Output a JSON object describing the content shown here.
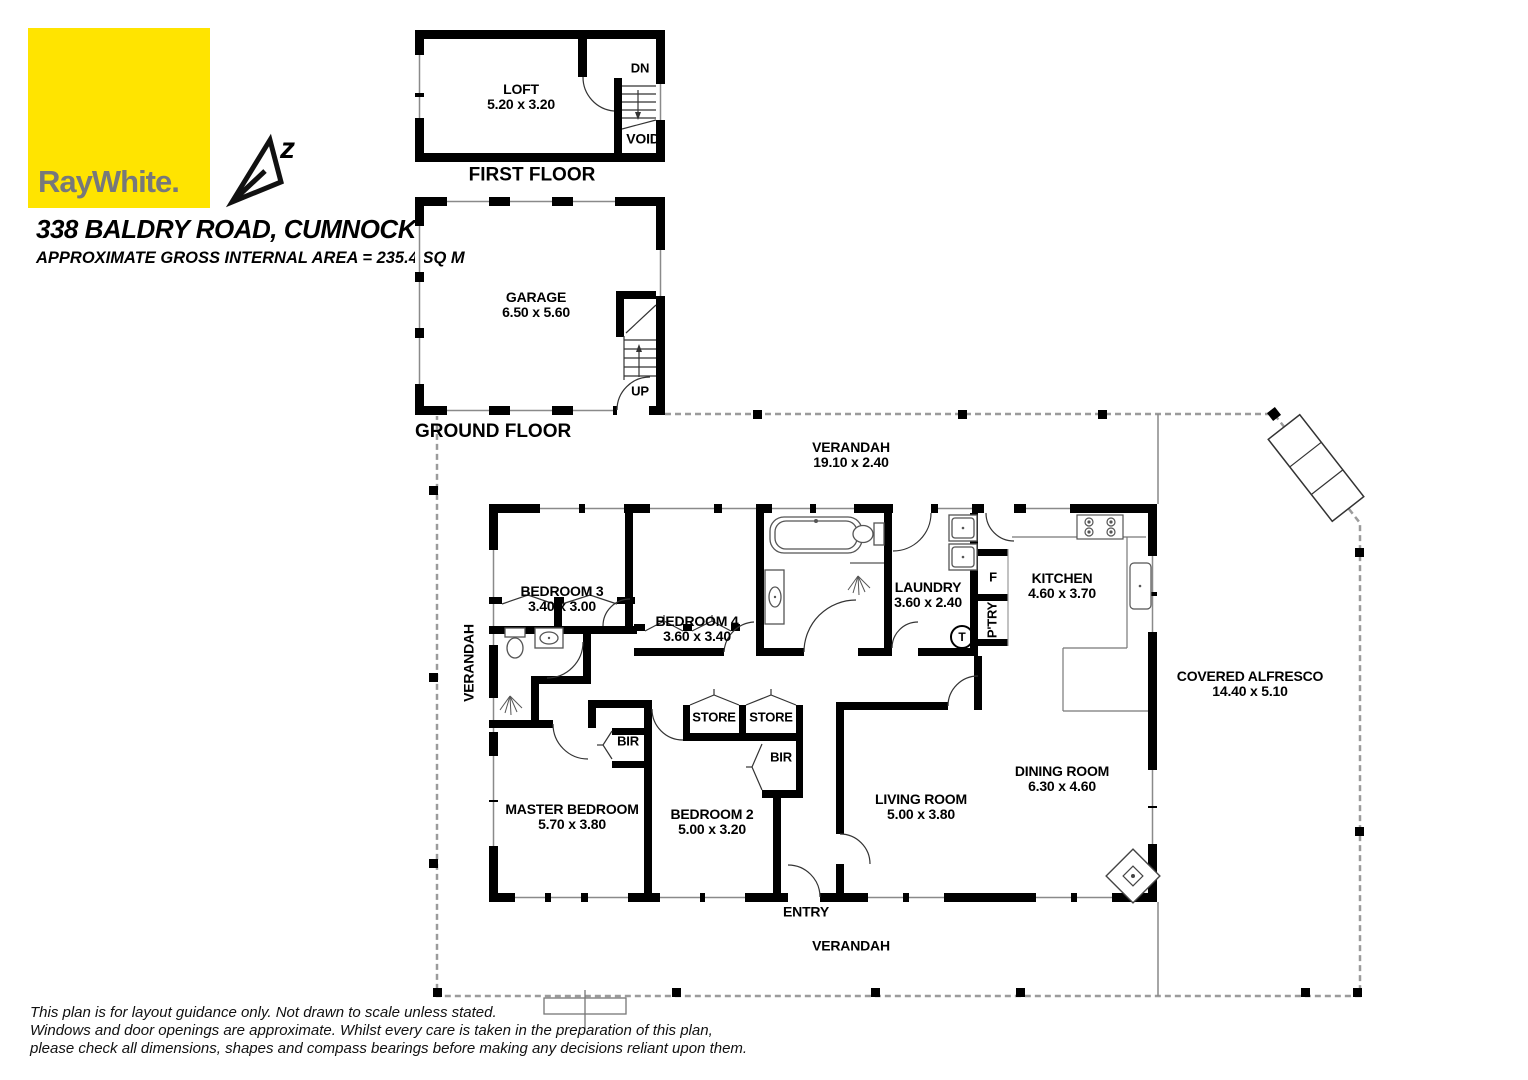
{
  "colors": {
    "brand_yellow": "#ffe400",
    "brand_gray": "#77787b",
    "wall": "#000000"
  },
  "brand": {
    "logo_text": "RayWhite.",
    "compass_letter": "z"
  },
  "header": {
    "address": "338 BALDRY ROAD, CUMNOCK",
    "area_line": "APPROXIMATE GROSS INTERNAL AREA = 235.4 SQ M"
  },
  "first_floor": {
    "title": "FIRST FLOOR",
    "room": "LOFT",
    "dims": "5.20 x 3.20",
    "dn": "DN",
    "void": "VOID"
  },
  "ground_floor": {
    "title": "GROUND FLOOR",
    "room": "GARAGE",
    "dims": "6.50 x 5.60",
    "up": "UP"
  },
  "plan": {
    "verandah_top": {
      "name": "VERANDAH",
      "dims": "19.10 x 2.40"
    },
    "verandah_left": "VERANDAH",
    "verandah_bottom": "VERANDAH",
    "alfresco": {
      "name": "COVERED ALFRESCO",
      "dims": "14.40 x 5.10"
    },
    "entry": "ENTRY",
    "bedroom3": {
      "name": "BEDROOM 3",
      "dims": "3.40 x 3.00"
    },
    "bedroom4": {
      "name": "BEDROOM 4",
      "dims": "3.60 x 3.40"
    },
    "laundry": {
      "name": "LAUNDRY",
      "dims": "3.60 x 2.40"
    },
    "kitchen": {
      "name": "KITCHEN",
      "dims": "4.60 x 3.70"
    },
    "master": {
      "name": "MASTER BEDROOM",
      "dims": "5.70 x 3.80"
    },
    "bedroom2": {
      "name": "BEDROOM 2",
      "dims": "5.00 x 3.20"
    },
    "living": {
      "name": "LIVING ROOM",
      "dims": "5.00 x 3.80"
    },
    "dining": {
      "name": "DINING ROOM",
      "dims": "6.30 x 4.60"
    },
    "store1": "STORE",
    "store2": "STORE",
    "bir_master": "BIR",
    "bir_bed2": "BIR",
    "fridge": "F",
    "pantry": "P'TRY",
    "tank": "T"
  },
  "disclaimer": {
    "line1": "This plan is for layout guidance only. Not drawn to scale unless stated.",
    "line2": "Windows and door openings are approximate. Whilst every care is taken in the preparation of this plan,",
    "line3": "please check all dimensions, shapes and compass bearings before making any decisions reliant upon them."
  }
}
